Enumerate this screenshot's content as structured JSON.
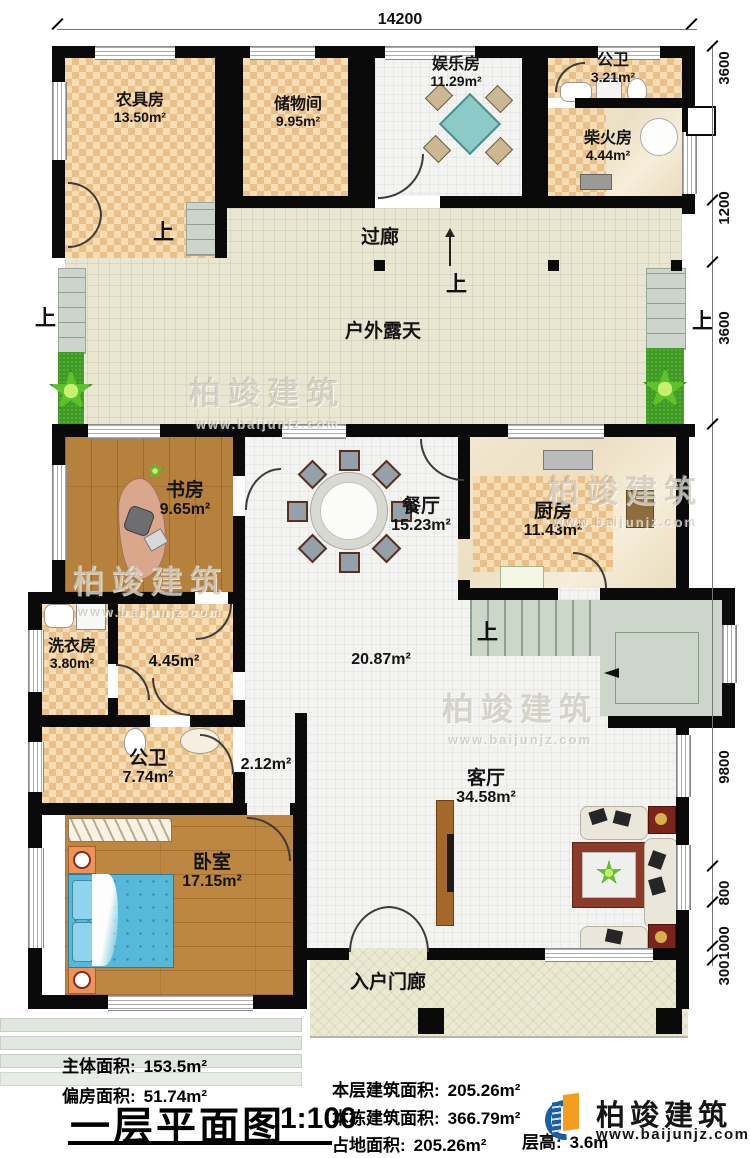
{
  "dims": {
    "top": "14200",
    "right": [
      "3600",
      "1200",
      "3600",
      "9800",
      "800",
      "1000",
      "300"
    ]
  },
  "up_label": "上",
  "rooms": {
    "nongju": {
      "name": "农具房",
      "area": "13.50m²"
    },
    "chuwu": {
      "name": "储物间",
      "area": "9.95m²"
    },
    "yule": {
      "name": "娱乐房",
      "area": "11.29m²"
    },
    "gongwei_top": {
      "name": "公卫",
      "area": "3.21m²"
    },
    "chaihuo": {
      "name": "柴火房",
      "area": "4.44m²"
    },
    "guolang": {
      "name": "过廊"
    },
    "huwai": {
      "name": "户外露天"
    },
    "shufang": {
      "name": "书房",
      "area": "9.65m²"
    },
    "canting": {
      "name": "餐厅",
      "area": "15.23m²"
    },
    "chufang": {
      "name": "厨房",
      "area": "11.43m²"
    },
    "xiyifang": {
      "name": "洗衣房",
      "area": "3.80m²"
    },
    "hallway": {
      "area": "4.45m²"
    },
    "center": {
      "area": "20.87m²"
    },
    "gongwei_main": {
      "name": "公卫",
      "area": "7.74m²"
    },
    "passage": {
      "area": "2.12m²"
    },
    "woshi": {
      "name": "卧室",
      "area": "17.15m²"
    },
    "keting": {
      "name": "客厅",
      "area": "34.58m²"
    },
    "menlang": {
      "name": "入户门廊"
    }
  },
  "footer": {
    "main_area_label": "主体面积:",
    "main_area_value": "153.5m²",
    "annex_area_label": "偏房面积:",
    "annex_area_value": "51.74m²",
    "title": "一层平面图",
    "scale": "1:100",
    "floor_area_label": "本层建筑面积:",
    "floor_area_value": "205.26m²",
    "total_area_label": "本栋建筑面积:",
    "total_area_value": "366.79m²",
    "footprint_label": "占地面积:",
    "footprint_value": "205.26m²",
    "height_label": "层高:",
    "height_value": "3.6m"
  },
  "brand": {
    "name": "柏竣建筑",
    "url": "www.baijunjz.com"
  },
  "wm": {
    "name": "柏竣建筑",
    "url": "www.baijunjz.com"
  }
}
